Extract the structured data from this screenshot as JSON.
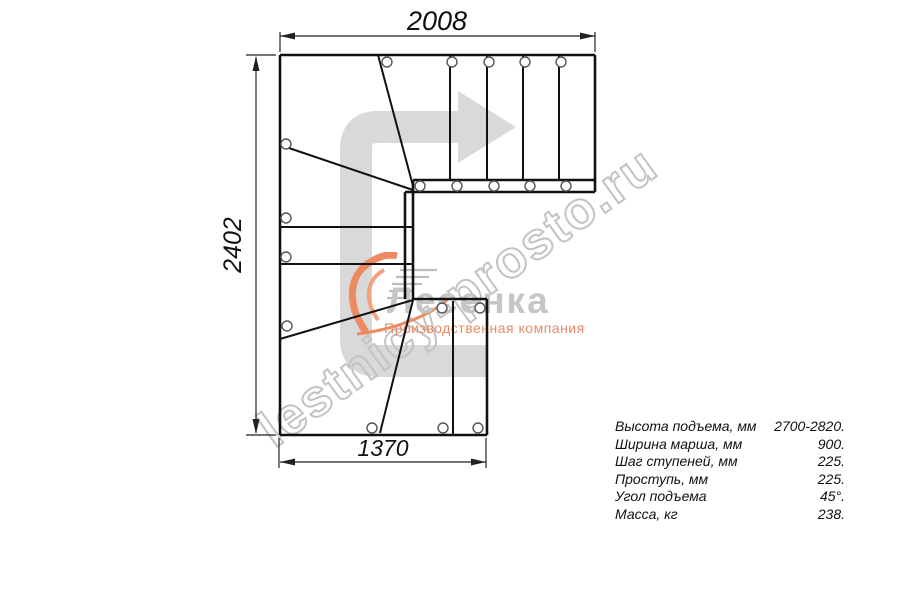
{
  "document": {
    "type": "staircase-plan-blueprint",
    "background": "#ffffff"
  },
  "drawing": {
    "dimensions": {
      "top_width_mm": "2008",
      "left_height_mm": "2402",
      "bottom_width_mm": "1370"
    },
    "direction_arrow": "staircase-walk-direction-turn-right",
    "line_color": "#111111",
    "arrow_color": "#d9d9d9"
  },
  "watermark": {
    "site": "lestnicy-prosto.ru",
    "outline_color": "#c3c3c3"
  },
  "logo": {
    "name": "Лесенка",
    "tagline": "Производственная компания",
    "accent_color": "#ee8a5f",
    "name_color": "#c6c6c6"
  },
  "specs": {
    "rows": [
      {
        "label": "Высота подъема, мм",
        "value": "2700-2820."
      },
      {
        "label": "Ширина марша, мм",
        "value": "900."
      },
      {
        "label": "Шаг ступеней, мм",
        "value": "225."
      },
      {
        "label": "Проступь, мм",
        "value": "225."
      },
      {
        "label": "Угол подъема",
        "value": "45°."
      },
      {
        "label": "Масса, кг",
        "value": "238."
      }
    ]
  }
}
